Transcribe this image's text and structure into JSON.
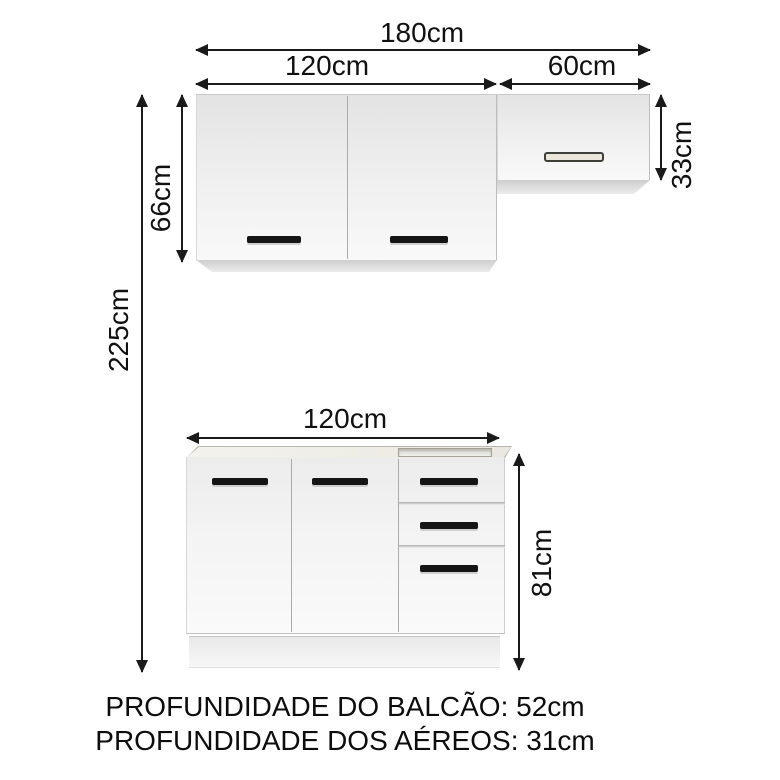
{
  "diagram": {
    "dims": {
      "total_width": "180cm",
      "upper_left_width": "120cm",
      "upper_right_width": "60cm",
      "upper_left_height": "66cm",
      "upper_right_height": "33cm",
      "total_height": "225cm",
      "base_width": "120cm",
      "base_height": "81cm"
    },
    "notes": {
      "balcao_depth": "PROFUNDIDADE DO BALCÃO: 52cm",
      "aereos_depth": "PROFUNDIDADE DOS AÉREOS: 31cm"
    },
    "colors": {
      "dimension_line": "#1a1a1a",
      "text": "#0d0d0d",
      "cabinet_face_light": "#f9f9f9",
      "cabinet_face_shade": "#e3e3e3",
      "underside_shade": "#cecece",
      "handle_dark": "#151515",
      "slot_handle_fill": "#eae6d9",
      "counter_edge": "#b9b9af"
    }
  }
}
